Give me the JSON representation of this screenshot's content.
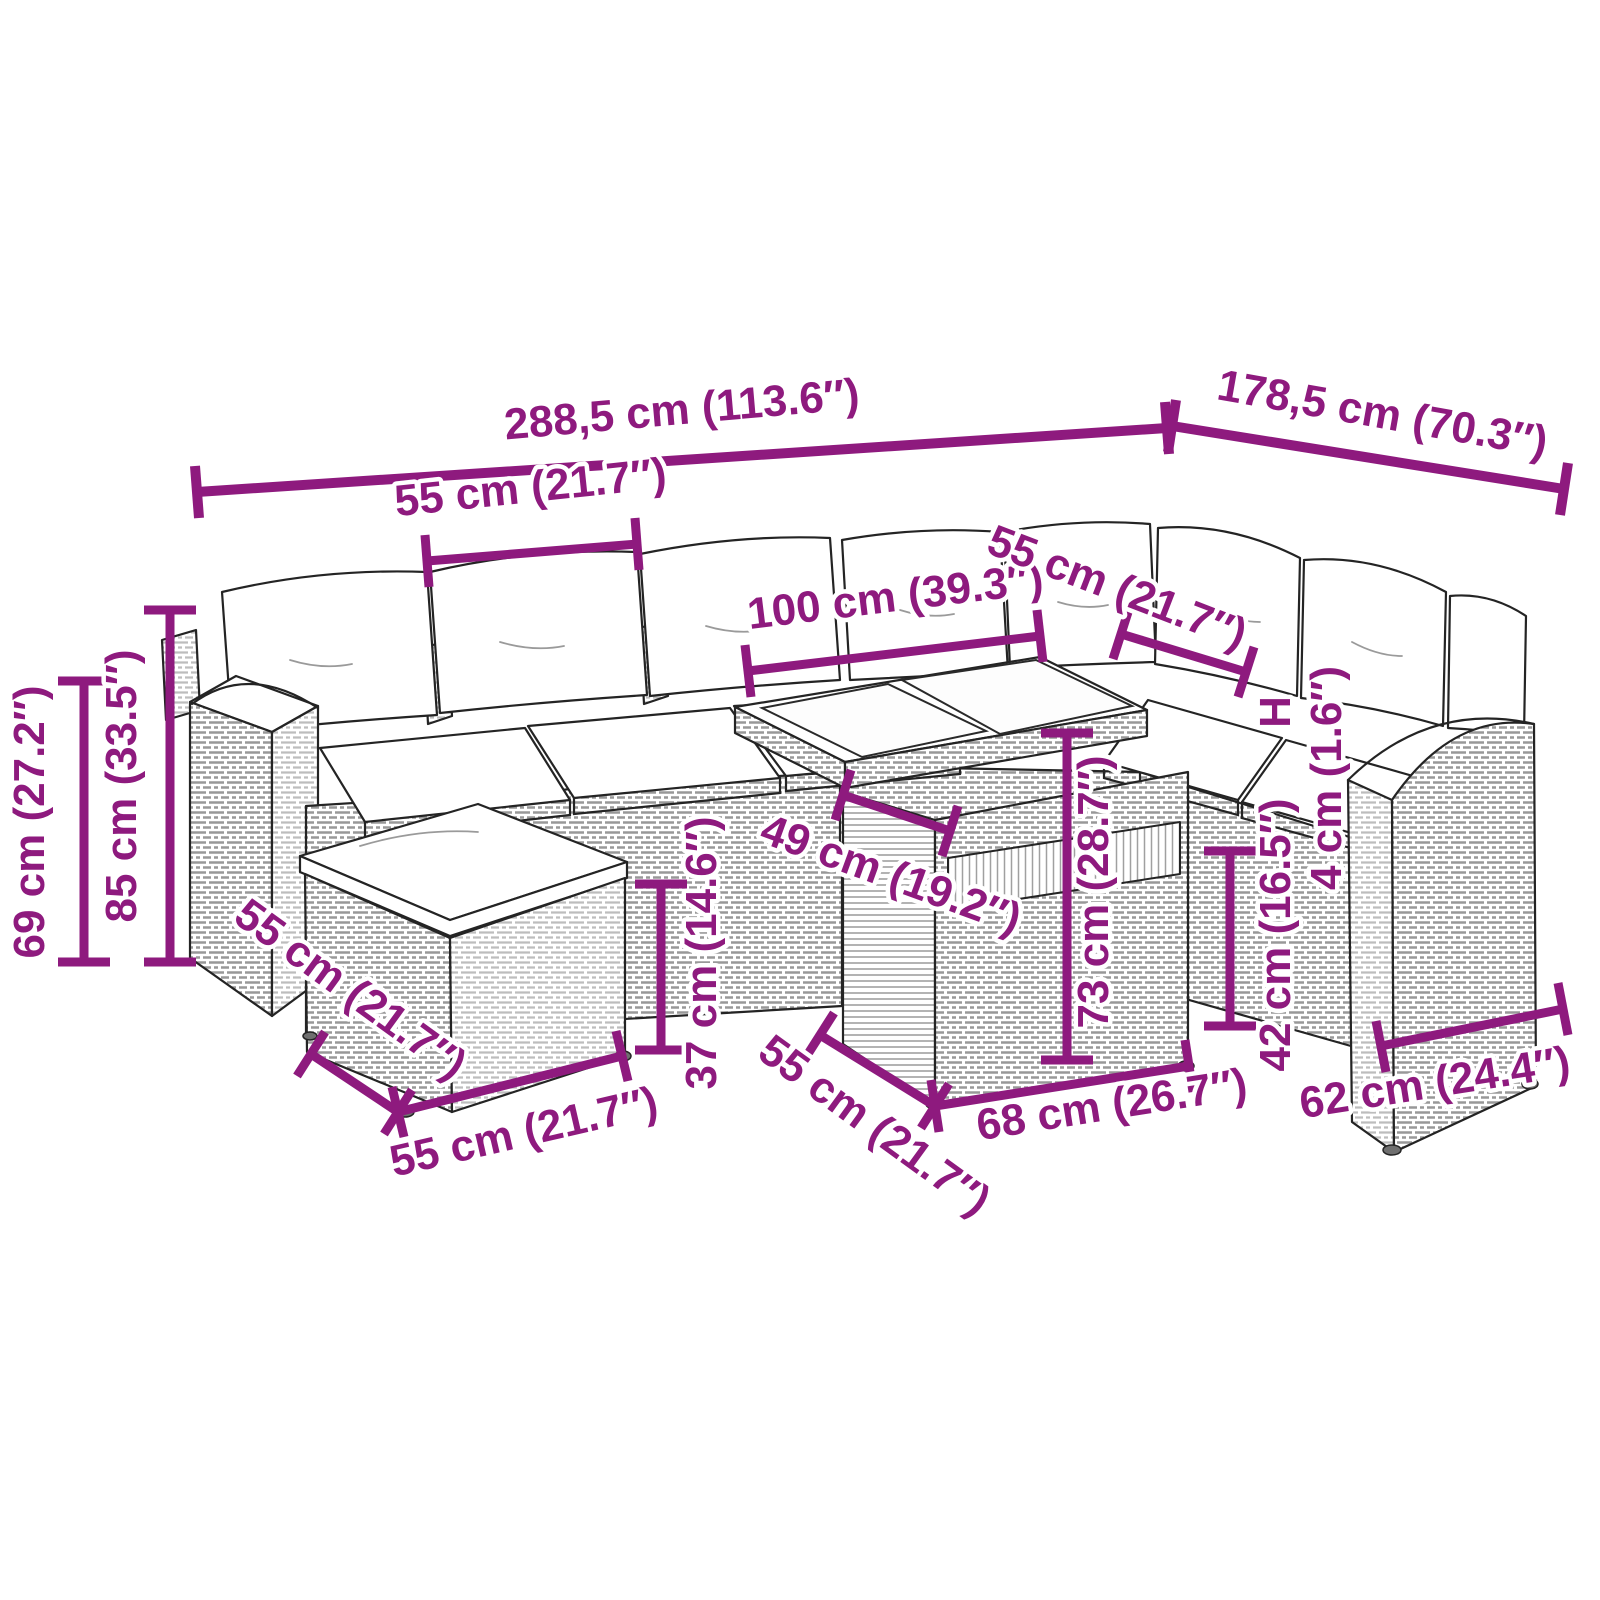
{
  "diagram": {
    "accent_color": "#8e1a7e",
    "outline_color": "#242424",
    "background_color": "#ffffff",
    "dimension_labels": [
      {
        "name": "overall-width",
        "text": "288,5 cm (113.6″)"
      },
      {
        "name": "overall-depth",
        "text": "178,5 cm (70.3″)"
      },
      {
        "name": "back-cushion-width",
        "text": "55 cm (21.7″)"
      },
      {
        "name": "table-top-length",
        "text": "100 cm (39.3″)"
      },
      {
        "name": "right-seat-width",
        "text": "55 cm (21.7″)"
      },
      {
        "name": "height-to-seat-back",
        "text": "69 cm (27.2″)"
      },
      {
        "name": "total-height",
        "text": "85 cm (33.5″)"
      },
      {
        "name": "ottoman-depth",
        "text": "55 cm (21.7″)"
      },
      {
        "name": "ottoman-width",
        "text": "55 cm (21.7″)"
      },
      {
        "name": "ottoman-height",
        "text": "37 cm (14.6″)"
      },
      {
        "name": "table-clearance",
        "text": "49 cm (19.2″)"
      },
      {
        "name": "table-base-depth",
        "text": "55 cm (21.7″)"
      },
      {
        "name": "table-base-width",
        "text": "68 cm (26.7″)"
      },
      {
        "name": "table-height",
        "text": "73 cm (28.7″)"
      },
      {
        "name": "seat-height",
        "text": "42 cm (16.5″)"
      },
      {
        "name": "height-marker",
        "text": "H"
      },
      {
        "name": "tabletop-thickness",
        "text": "4 cm (1.6″)"
      },
      {
        "name": "armrest-module-depth",
        "text": "62 cm (24.4″)"
      }
    ]
  }
}
